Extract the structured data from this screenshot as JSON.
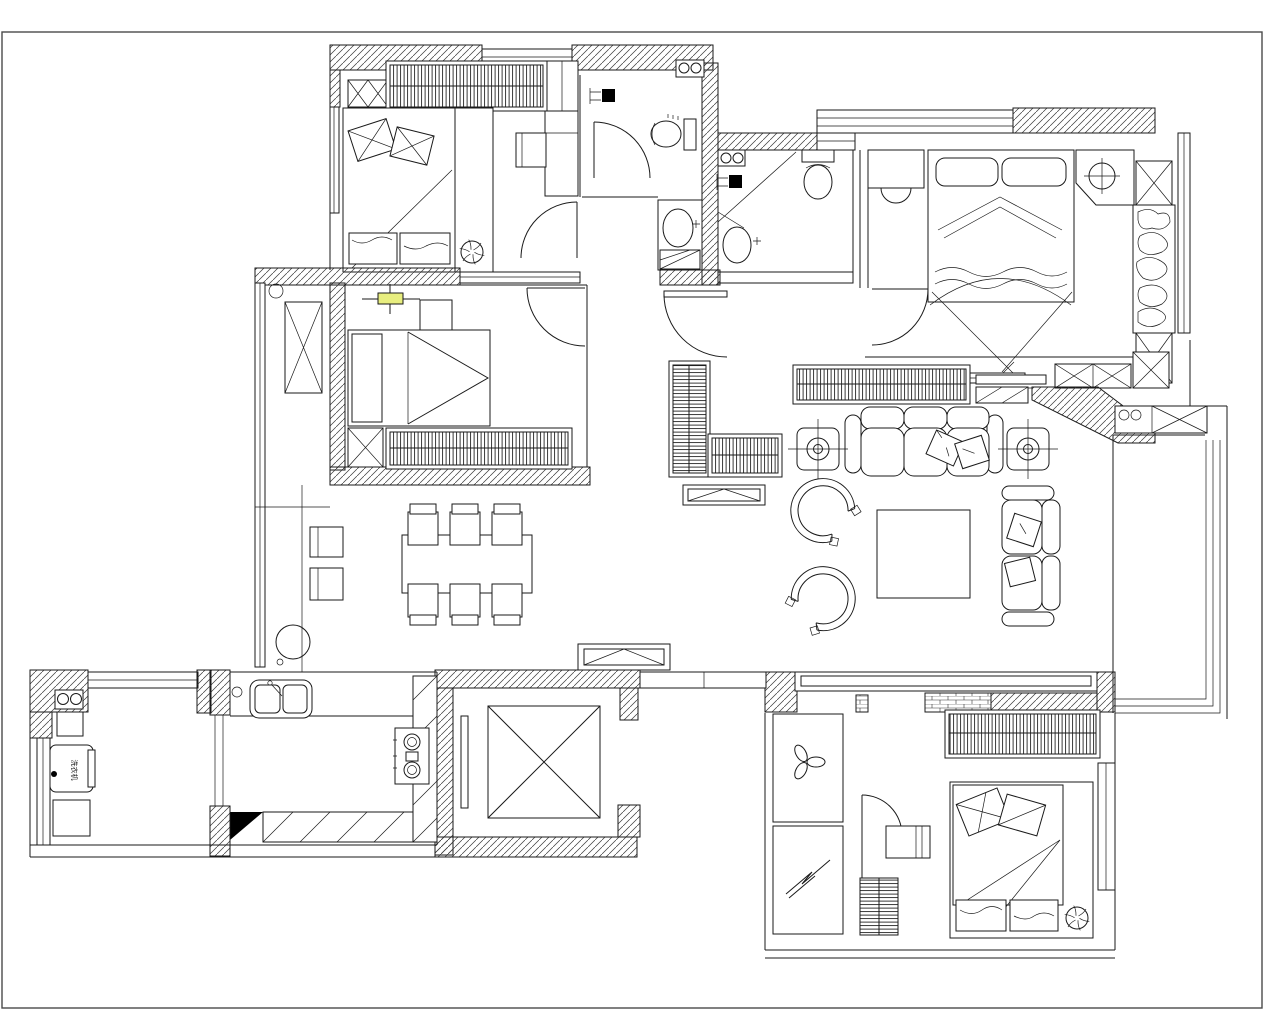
{
  "drawing": {
    "kind": "apartment-floor-plan",
    "labels": {
      "washing_machine": "洗衣机"
    },
    "colors": {
      "line": "#1a1a1a",
      "paper": "#ffffff",
      "frame": "#4a4a4a",
      "highlight": "#e8ee7f",
      "fixture": "#000000"
    },
    "icons": [
      "double-bed-icon",
      "single-bed-icon",
      "wardrobe-icon",
      "hanging-clothes-icon",
      "ceiling-fan-icon",
      "desk-icon",
      "chair-icon",
      "door-swing-icon",
      "toilet-icon",
      "wash-basin-icon",
      "shower-head-icon",
      "sofa-3-seat-icon",
      "sofa-2-seat-icon",
      "armchair-icon",
      "coffee-table-icon",
      "side-table-planter-icon",
      "tv-icon",
      "tv-cabinet-icon",
      "shoe-cabinet-icon",
      "dining-table-icon",
      "dining-chair-icon",
      "stool-icon",
      "kitchen-sink-icon",
      "gas-stove-icon",
      "washing-machine-icon",
      "water-heater-icon",
      "elevator-icon",
      "flue-vent-icon",
      "exhaust-fan-icon",
      "lightning-symbol-icon",
      "window-icon",
      "wall-hatch-pattern",
      "brick-wall-pattern",
      "light-fixture-highlight-icon",
      "x-cabinet-icon"
    ]
  }
}
